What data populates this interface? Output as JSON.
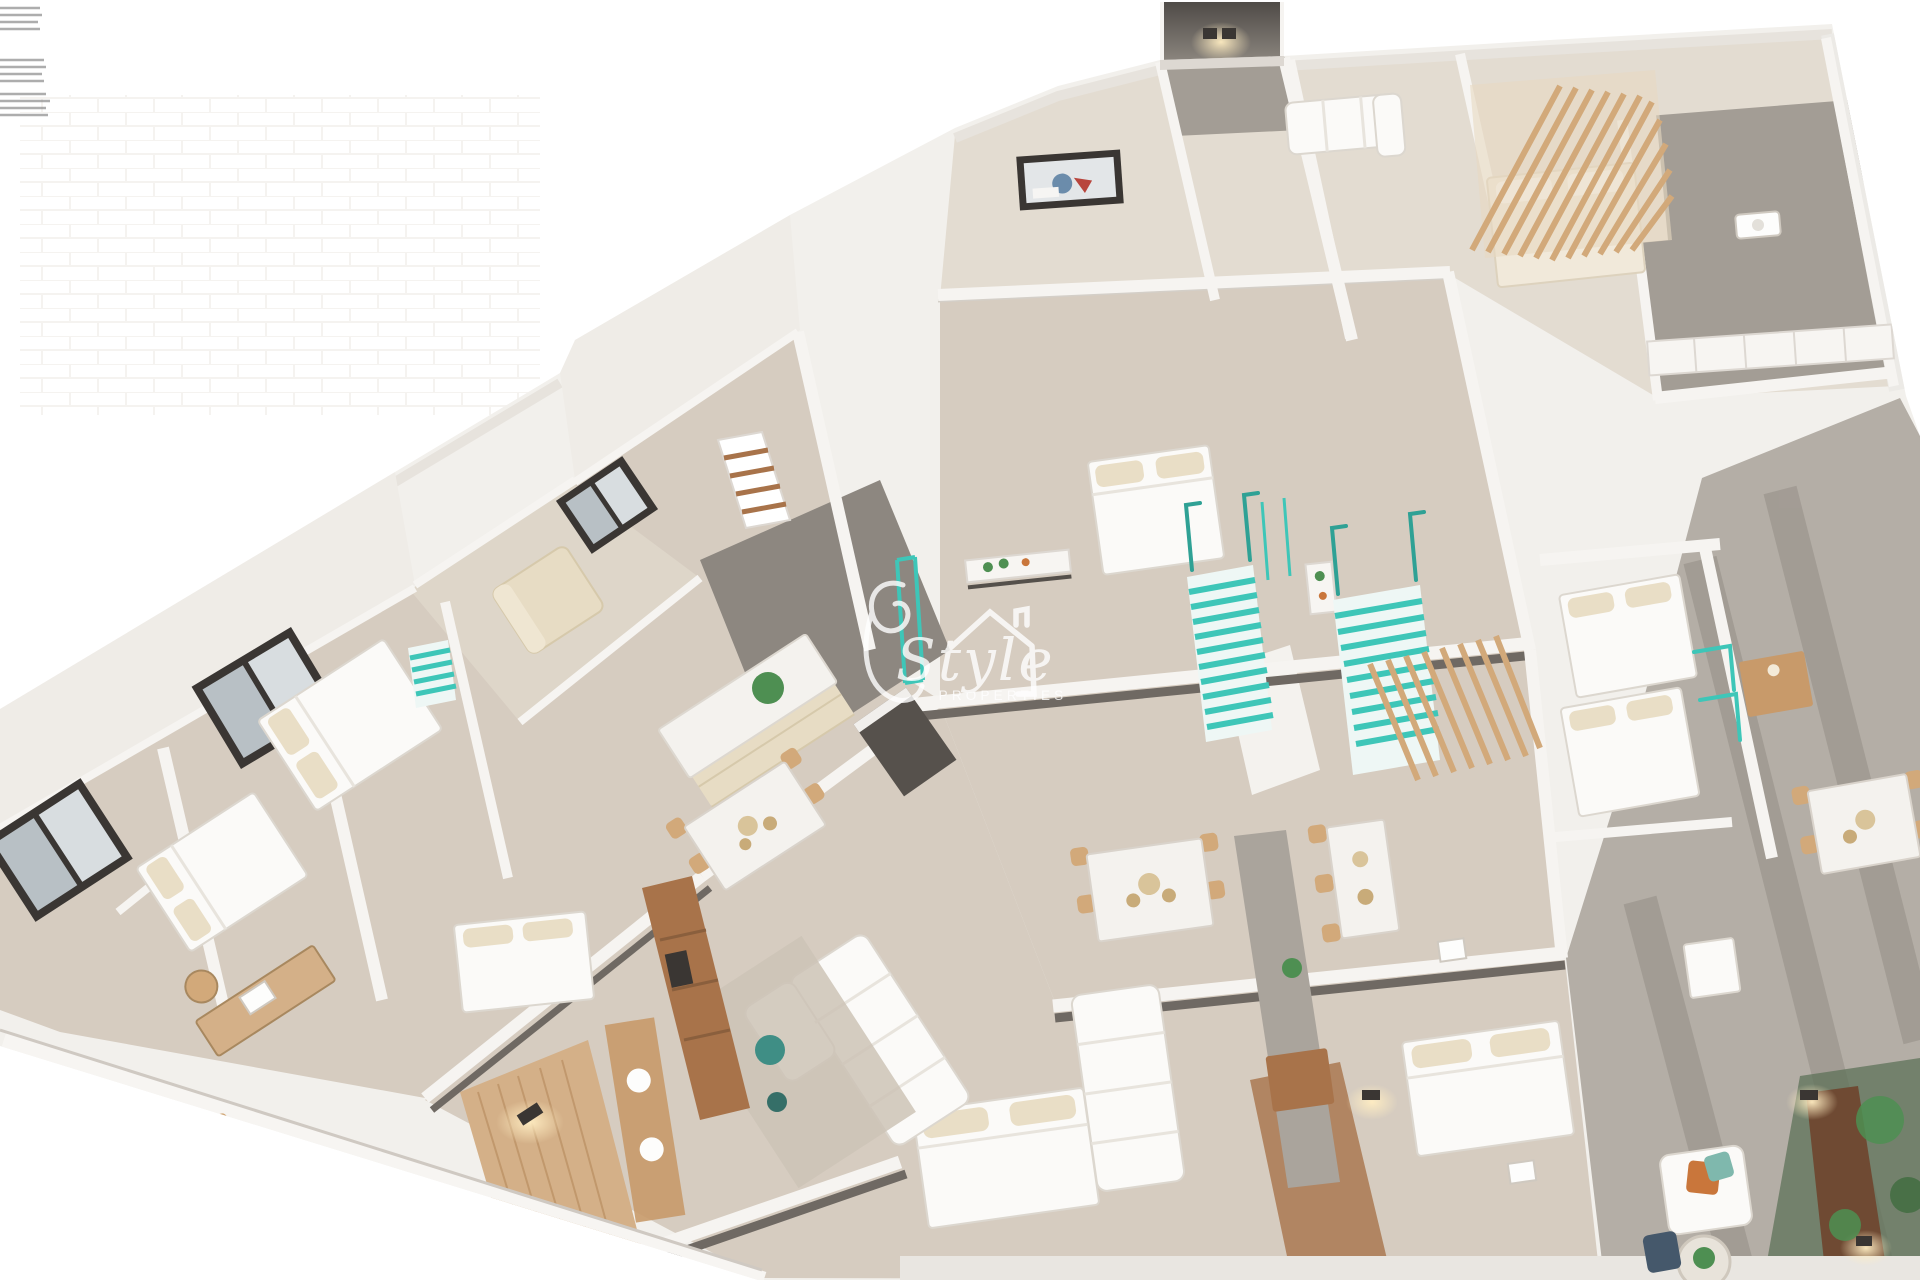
{
  "image": {
    "type": "3d-floorplan-render",
    "description": "Isometric 3D rendering of an apartment building storey with several furnished units, teal staircases, wood pergola and terraces",
    "width": 1920,
    "height": 1280
  },
  "watermark": {
    "script_text": "Style",
    "subtext": "PROPERTIES",
    "house_icon": "roof-with-chimney-icon",
    "color": "#ffffff",
    "opacity": 0.8
  },
  "scene": {
    "style": "isometric-3d-render",
    "elements": [
      "apartment-walls",
      "beige-floors",
      "teal-staircases",
      "elevator-shaft",
      "wood-pergola",
      "wood-slat-screen",
      "balcony-glass-railings",
      "beds",
      "sofas",
      "dining-sets",
      "kitchen-islands",
      "office-desk",
      "wall-sconces",
      "ceiling-lights",
      "plants",
      "rug",
      "terrace",
      "garden-patio",
      "wardrobe",
      "tv-console"
    ],
    "counts": {
      "beds": 9,
      "sofas": 4,
      "dining_sets": 5,
      "staircases": 3,
      "kitchen_islands": 2
    }
  },
  "palette": {
    "bg": "#ffffff",
    "wall": "#f2f0ec",
    "wallFace": "#efece7",
    "wallEdge": "#d2cdc6",
    "wallShade": "#e6e2dc",
    "floor": "#d6ccc0",
    "floorLight": "#e3dcd1",
    "floorPale": "#ded6c9",
    "corridor": "#8d8780",
    "darkStrip": "#6f6963",
    "terrace": "#b4aea6",
    "terraceDark": "#958f87",
    "grayFloor": "#a39d95",
    "wood": "#c89a6a",
    "woodDark": "#a8734a",
    "woodFloor": "#d4b088",
    "woodSlat": "#d2a97a",
    "teal": "#3ec6b8",
    "tealDark": "#2fa195",
    "marble": "#f4f2ee",
    "cream": "#e9dec6",
    "beige": "#e7dcc4",
    "white": "#ffffff",
    "frame": "#3a3633",
    "glass": "#b8c0c5",
    "green": "#4e8f52",
    "greenDark": "#5d7258",
    "orange": "#c9763b",
    "navy": "#45586b",
    "blue": "#6b8cab",
    "glow": "#ffedc2"
  }
}
